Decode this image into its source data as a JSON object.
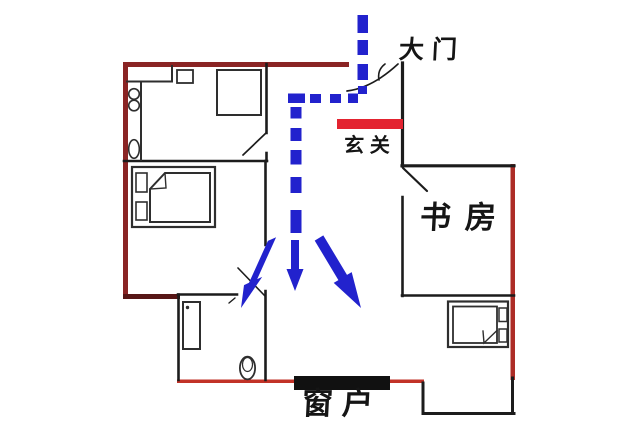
{
  "labels": {
    "main_door": "大门",
    "entryway": "玄关",
    "study": "书房",
    "window": "窗户"
  },
  "colors": {
    "flow_blue": "#2222cd",
    "accent_red": "#e32330",
    "outer_wall": "#8a2424",
    "outer_wall_dark": "#571616",
    "bottom_wall_red": "#c23227",
    "right_wall_red": "#ad2c26",
    "inner_wall": "#1c1c1c",
    "furniture_line": "#2e2e2e",
    "window_bar": "#111111",
    "background": "#ffffff"
  }
}
